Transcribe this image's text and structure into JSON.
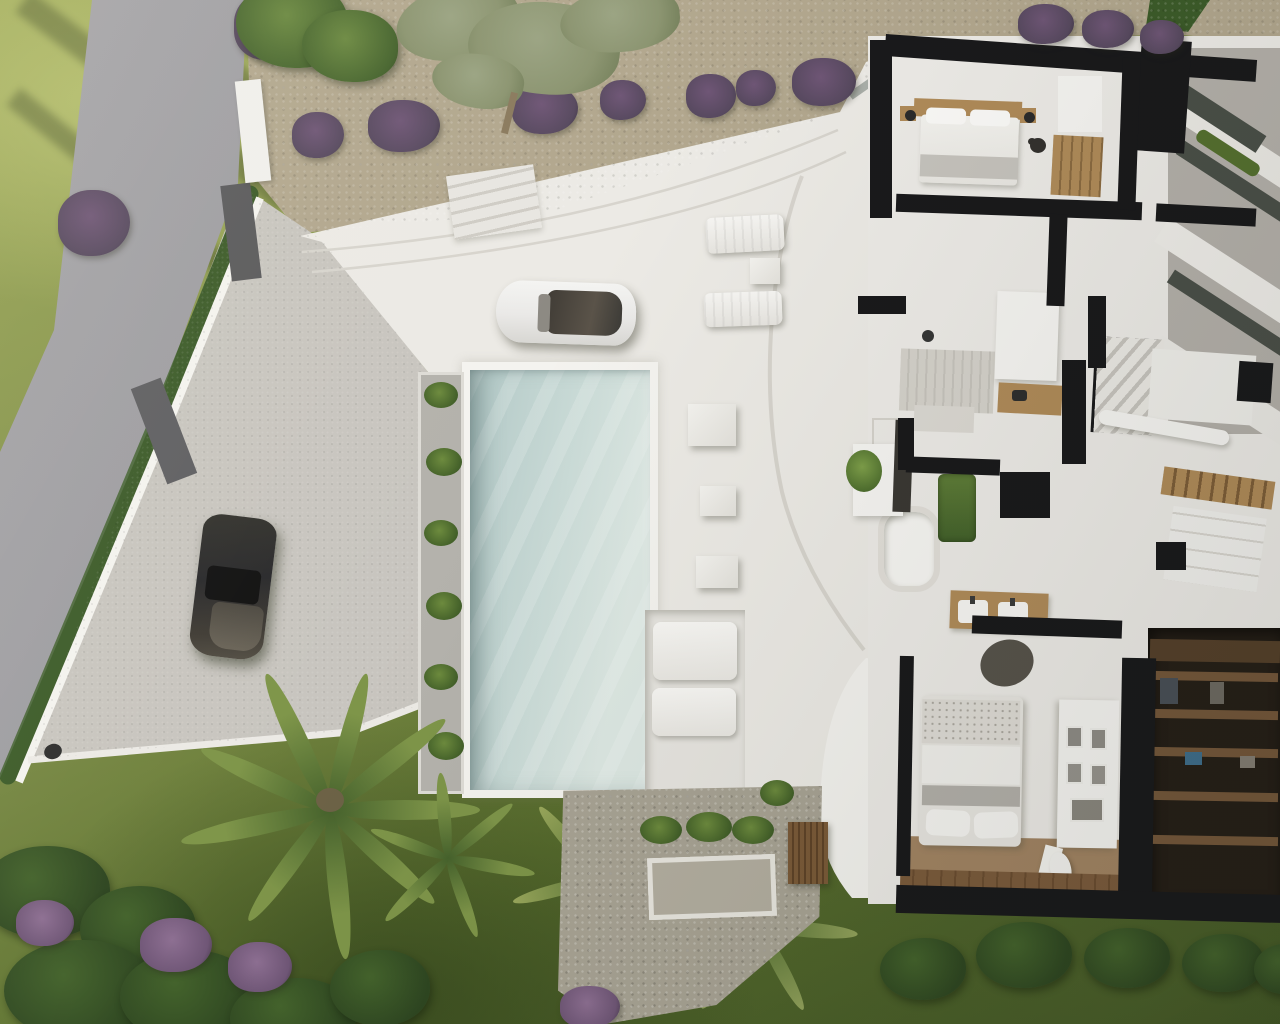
{
  "meta": {
    "description": "Aerial top-down 3D architectural rendering of a modern white villa: road and hedge-lined boundary wall on the left, stone driveway with a parked black SUV and white car, long rectangular swimming pool with planters and sun loungers, gravel slopes with lavender bushes, palm trees and flowering garden, and a dollhouse cutaway floor plan of the house interior on the right showing bedrooms, bathrooms, stairs and a dark walk-in closet.",
    "render_style": "photorealistic architectural visualization, no visible text"
  },
  "colors": {
    "grass-light": "#9aa654",
    "grass-mid": "#81904a",
    "grass-dark": "#5d7230",
    "grass-deep": "#3c5122",
    "road": "#97969b",
    "driveway": "#c8c5bf",
    "gravel": "#b2a78e",
    "pebble": "#a8a394",
    "terrace": "#eceae5",
    "terrace-bright": "#f4f3ef",
    "step-line": "#d7d4cd",
    "pool-light": "#dde8e3",
    "pool-mid": "#cadbd7",
    "pool-deep": "#b2c8c6",
    "wall-black": "#19191b",
    "floor": "#edebe7",
    "white-wall": "#f6f5f2",
    "wood": "#b08b59",
    "wood-dark": "#74573a",
    "closet-dark": "#251e17",
    "floor-brown": "#a28463",
    "hedge": "#3c5b29",
    "bush-dark": "#2e4621",
    "palm-dark": "#46622c",
    "palm-light": "#7e9549",
    "lavender": "#57495f",
    "flower-purple": "#6f5676",
    "olive": "#8b9470",
    "car-white": "#eae9e7",
    "car-dark": "#2a2a2c",
    "glass": "#4a4f48",
    "concrete": "#b4b0aa",
    "tile": "#d5d2cb"
  },
  "scene": {
    "ground_areas": [
      "grass lawn",
      "asphalt road",
      "stone driveway",
      "gravel slope",
      "white terrace",
      "pebble patio"
    ],
    "water": [
      "swimming pool"
    ],
    "vehicles": [
      "white car on driveway",
      "black SUV near boundary wall"
    ],
    "vegetation": [
      "boundary hedge",
      "lavender bushes row",
      "olive tree",
      "palm trees",
      "purple flower beds",
      "dark green bushes row",
      "pool planter shrubs"
    ],
    "outdoor_furniture": [
      "two sun loungers with side table",
      "sunken lounge with two mattresses",
      "white step cubes"
    ],
    "floorplan_rooms": [
      "master bedroom",
      "hallway wardrobe",
      "upper terrace with glass railing",
      "shower bathroom",
      "staircase",
      "central bathroom with bathtub and double vanity",
      "second bedroom",
      "walk-in closet",
      "lower bedroom with gallery wall"
    ],
    "floorplan_objects": [
      "double bed with wood headboard",
      "bedside lamps",
      "bathtub",
      "double sink vanity",
      "shower tiles",
      "wardrobe shelves with clothes",
      "picture frames",
      "small white pet",
      "entrance glass door",
      "interior plants"
    ]
  }
}
